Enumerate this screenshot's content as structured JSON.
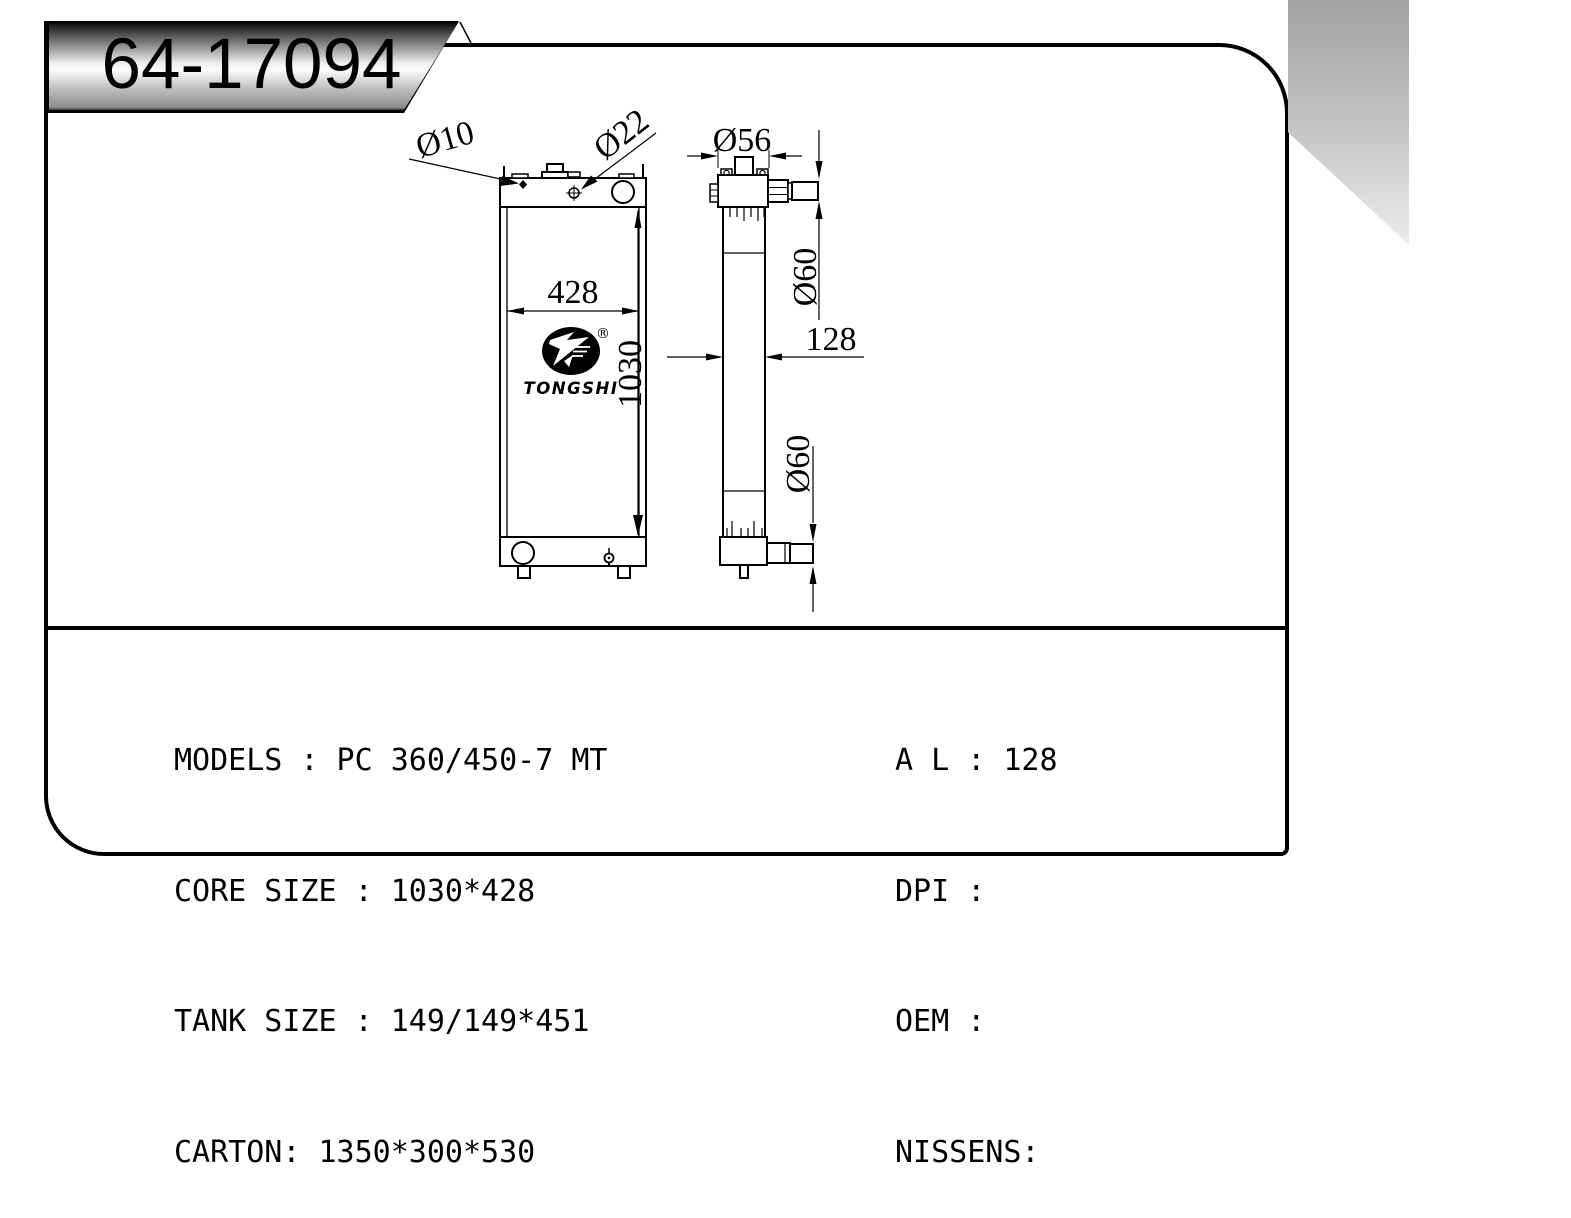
{
  "banner": {
    "part_number": "64-17094"
  },
  "drawing": {
    "front_view": {
      "width_dim": "428",
      "height_dim": "1030",
      "hole_label": "Ø10",
      "filler_label": "Ø22"
    },
    "side_view": {
      "neck_dim": "Ø56",
      "top_pipe_dim": "Ø60",
      "bottom_pipe_dim": "Ø60",
      "depth_dim": "128"
    },
    "logo": {
      "brand": "TONGSHI",
      "registered_mark": "®"
    }
  },
  "specs": {
    "left_rows": [
      {
        "text": "MODELS : PC 360/450-7 MT"
      },
      {
        "text": "CORE SIZE : 1030*428"
      },
      {
        "text": "TANK SIZE : 149/149*451"
      },
      {
        "text": "CARTON: 1350*300*530"
      }
    ],
    "right_rows": [
      {
        "text": "A L : 128"
      },
      {
        "text": "DPI :"
      },
      {
        "text": "OEM :"
      },
      {
        "text": "NISSENS:"
      }
    ]
  },
  "colors": {
    "line": "#000000",
    "background": "#ffffff"
  }
}
